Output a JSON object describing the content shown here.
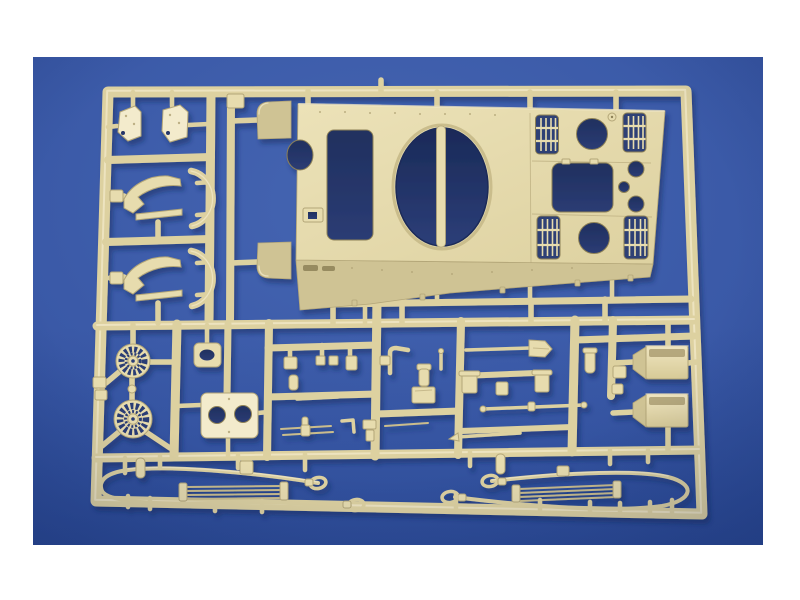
{
  "scene": {
    "type": "product photograph",
    "subject": "Tan plastic model-kit sprue with tank upper hull and detail parts",
    "description": "Photograph of a tan injection-molded model kit sprue on a blue backdrop with a white border. The sprue holds a tank upper hull with turret-ring opening and vented engine deck, plus fenders, cooling fans, hatch plates, stowage boxes, tow cables and many small fittings.",
    "backdrop": "blue studio background",
    "mat": "white photo border"
  },
  "colors": {
    "mat": "#ffffff",
    "backdrop-light": "#4565b2",
    "backdrop-mid": "#3a59a7",
    "backdrop-dark": "#2c4b99",
    "backdrop-deep": "#22418a",
    "hole-dark": "#20305f",
    "hole-mid": "#2b3c74",
    "plastic-light": "#f3ebcc",
    "plastic-mid": "#e7dcae",
    "plastic-base": "#ddd1a0",
    "plastic-band": "#cfc394",
    "plastic-shadow": "#b3a678",
    "plastic-deep": "#8d8157",
    "shadow": "#16265c"
  },
  "sprue": {
    "material": "injection-molded polystyrene",
    "color_name": "tan",
    "grille_count": 4,
    "fan_opening_count": 2,
    "tow_cable_count": 2,
    "parts": [
      {
        "name": "upper hull",
        "count": 1
      },
      {
        "name": "front fender corner",
        "count": 2
      },
      {
        "name": "small hatch plate",
        "count": 2
      },
      {
        "name": "curved fender",
        "count": 2
      },
      {
        "name": "curved arc segment",
        "count": 2
      },
      {
        "name": "cooling fan",
        "count": 2
      },
      {
        "name": "oval fitting",
        "count": 1
      },
      {
        "name": "engine access plate",
        "count": 1
      },
      {
        "name": "stowage box",
        "count": 2
      },
      {
        "name": "tow cable",
        "count": 2
      },
      {
        "name": "shovel",
        "count": 1
      },
      {
        "name": "small fittings and rods",
        "count": 30
      }
    ]
  }
}
